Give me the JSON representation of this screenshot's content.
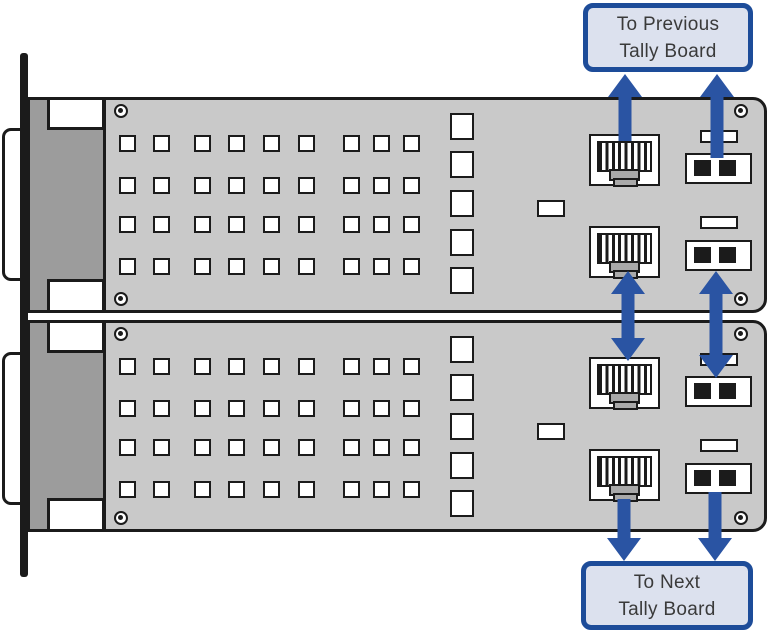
{
  "title": "Tally board daisy-chain connection diagram",
  "labels": {
    "previous": {
      "line1": "To Previous",
      "line2": "Tally Board"
    },
    "next": {
      "line1": "To Next",
      "line2": "Tally Board"
    }
  },
  "boards": [
    {
      "id": "tally-board-1",
      "grid_rows": 4,
      "grid_cols": 9,
      "slot_count": 5,
      "chip_count": 1,
      "rj45_jacks": 2,
      "jumper_blocks": 2,
      "jumper_pins_per_block": 2,
      "screws": 4,
      "dsub_connector": true
    },
    {
      "id": "tally-board-2",
      "grid_rows": 4,
      "grid_cols": 9,
      "slot_count": 5,
      "chip_count": 1,
      "rj45_jacks": 2,
      "jumper_blocks": 2,
      "jumper_pins_per_block": 2,
      "screws": 4,
      "dsub_connector": true
    }
  ],
  "arrows": [
    {
      "name": "arrow-up-rj45-to-previous",
      "direction": "up"
    },
    {
      "name": "arrow-up-jumper-to-previous",
      "direction": "up"
    },
    {
      "name": "arrow-double-rj45-between-boards",
      "direction": "both"
    },
    {
      "name": "arrow-double-jumper-between-boards",
      "direction": "both"
    },
    {
      "name": "arrow-down-rj45-to-next",
      "direction": "down"
    },
    {
      "name": "arrow-down-jumper-to-next",
      "direction": "down"
    }
  ],
  "colors": {
    "arrow_blue": "#2a54a3",
    "label_border": "#1d4c99",
    "label_fill": "#dce1ee",
    "board_gray": "#c9c9c9",
    "connector_gray": "#9c9c9c",
    "tab_gray": "#a9a9a9",
    "outline": "#1b1b1b",
    "text": "#3a3a3a"
  }
}
